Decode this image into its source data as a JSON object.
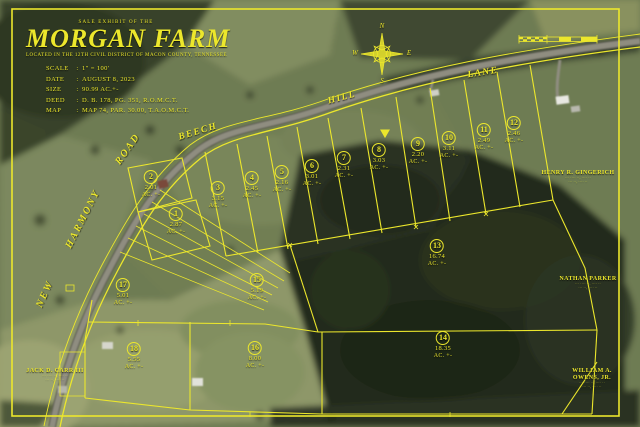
{
  "title_block": {
    "eyebrow": "SALE EXHIBIT OF THE",
    "title": "MORGAN FARM",
    "subtitle": "LOCATED IN THE 12TH CIVIL DISTRICT OF MACON COUNTY, TENNESSEE",
    "separator": ":",
    "details": [
      {
        "label": "SCALE",
        "value": "1\" = 100'"
      },
      {
        "label": "DATE",
        "value": "AUGUST 8, 2023"
      },
      {
        "label": "SIZE",
        "value": "90.99 AC.+-"
      },
      {
        "label": "DEED",
        "value": "D. B. 178, PG. 351, R.O.M.C.T."
      },
      {
        "label": "MAP",
        "value": "MAP 74, PAR. 30.00, T.A.O.M.C.T."
      }
    ]
  },
  "compass": {
    "north": "N",
    "east": "E",
    "south": "S",
    "west": "W"
  },
  "roads": [
    {
      "name": "NEW HARMONY ROAD",
      "words": [
        "NEW",
        "HARMONY",
        "ROAD"
      ]
    },
    {
      "name": "BEECH HILL LANE",
      "words": [
        "BEECH",
        "HILL",
        "LANE"
      ]
    }
  ],
  "lots": [
    {
      "num": "1",
      "acres": "2.87",
      "suffix": "AC. +-"
    },
    {
      "num": "2",
      "acres": "2.01",
      "suffix": "AC. +-"
    },
    {
      "num": "3",
      "acres": "3.15",
      "suffix": "AC. +-"
    },
    {
      "num": "4",
      "acres": "2.45",
      "suffix": "AC. +-"
    },
    {
      "num": "5",
      "acres": "2.16",
      "suffix": "AC. +-"
    },
    {
      "num": "6",
      "acres": "3.01",
      "suffix": "AC. +-"
    },
    {
      "num": "7",
      "acres": "2.31",
      "suffix": "AC. +-"
    },
    {
      "num": "8",
      "acres": "3.03",
      "suffix": "AC. +-"
    },
    {
      "num": "9",
      "acres": "2.20",
      "suffix": "AC. +-"
    },
    {
      "num": "10",
      "acres": "3.11",
      "suffix": "AC. +-"
    },
    {
      "num": "11",
      "acres": "2.49",
      "suffix": "AC. +-"
    },
    {
      "num": "12",
      "acres": "2.46",
      "suffix": "AC. +-"
    },
    {
      "num": "13",
      "acres": "16.74",
      "suffix": "AC. +-"
    },
    {
      "num": "14",
      "acres": "18.35",
      "suffix": "AC. +-"
    },
    {
      "num": "15",
      "acres": "5.19",
      "suffix": "AC. +-"
    },
    {
      "num": "16",
      "acres": "8.00",
      "suffix": "AC. +-"
    },
    {
      "num": "17",
      "acres": "5.01",
      "suffix": "AC. +-"
    },
    {
      "num": "18",
      "acres": "5.55",
      "suffix": "AC. +-"
    }
  ],
  "neighbors": [
    {
      "lines": [
        "HENRY R. GINGERICH"
      ],
      "fine1": "··· ···· ··, ···· ··",
      "fine2": "··· ··, ···· ··"
    },
    {
      "lines": [
        "NATHAN PARKER"
      ],
      "fine1": "··· ···· ··, ···· ··",
      "fine2": "··· ··, ···· ··"
    },
    {
      "lines": [
        "WILLIAM A.",
        "OWENS, JR."
      ],
      "fine1": "··· ···· ··, ···· ··",
      "fine2": "··· ··, ···· ··"
    },
    {
      "lines": [
        "JACK D. CARR III"
      ],
      "fine1": "··· ···· ··, ···· ··",
      "fine2": "··· ··, ···· ··"
    }
  ],
  "colors": {
    "overlay_yellow": "#ece72c",
    "woods_dark": "#242b1d",
    "field_green": "#7b885c",
    "road_gray": "#8f8d80"
  }
}
